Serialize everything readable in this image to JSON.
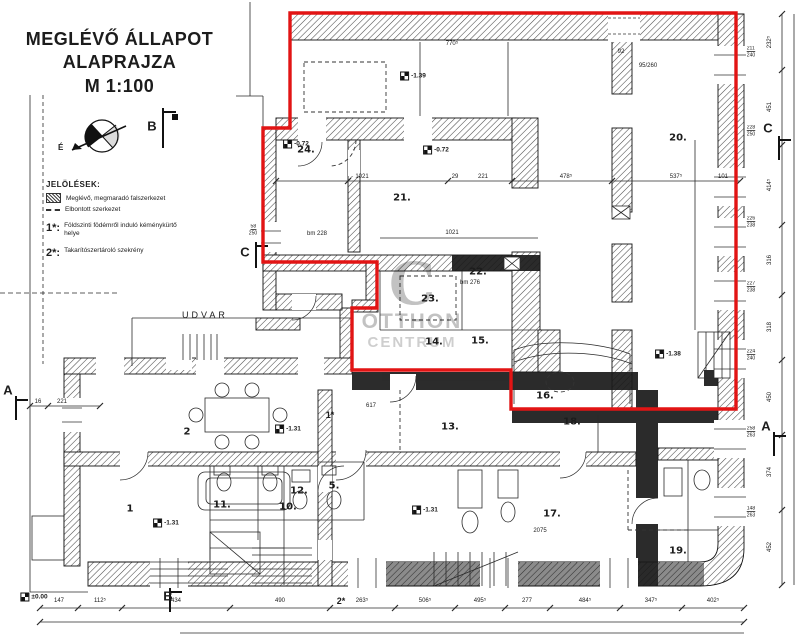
{
  "title_block": {
    "line1": "MEGLÉVŐ ÁLLAPOT",
    "line2": "ALAPRAJZA",
    "line3": "M 1:100"
  },
  "legend": {
    "heading": "JELÖLÉSEK:",
    "items": [
      {
        "swatch": "hatch",
        "label": "Meglévő, megmaradó falszerkezet"
      },
      {
        "swatch": "dashed",
        "label": "Elbontott szerkezet"
      }
    ],
    "notes": [
      {
        "key": "1*:",
        "label": "Földszinti födémről induló kéménykürtő helye"
      },
      {
        "key": "2*:",
        "label": "Takarítószertároló szekrény"
      }
    ]
  },
  "compass": {
    "north_label": "É"
  },
  "watermark": {
    "initial": "C",
    "line1": "OTTHON",
    "line2": "CENTRUM"
  },
  "colors": {
    "highlight_red": "#e21414",
    "ink": "#1c1c1c",
    "watermark_grey": "#8f8f8f"
  },
  "plan": {
    "courtyard_label": "UDVAR",
    "rooms": [
      {
        "n": "1",
        "x": 130,
        "y": 509
      },
      {
        "n": "2",
        "x": 187,
        "y": 432
      },
      {
        "n": "5.",
        "x": 334,
        "y": 486
      },
      {
        "n": "10.",
        "x": 288,
        "y": 507
      },
      {
        "n": "11.",
        "x": 222,
        "y": 505
      },
      {
        "n": "12.",
        "x": 299,
        "y": 491
      },
      {
        "n": "13.",
        "x": 450,
        "y": 427
      },
      {
        "n": "14.",
        "x": 434,
        "y": 342
      },
      {
        "n": "15.",
        "x": 480,
        "y": 341
      },
      {
        "n": "16.",
        "x": 545,
        "y": 396
      },
      {
        "n": "17.",
        "x": 552,
        "y": 514
      },
      {
        "n": "18.",
        "x": 572,
        "y": 422
      },
      {
        "n": "19.",
        "x": 678,
        "y": 551
      },
      {
        "n": "20.",
        "x": 678,
        "y": 138
      },
      {
        "n": "21.",
        "x": 402,
        "y": 198
      },
      {
        "n": "22.",
        "x": 478,
        "y": 272
      },
      {
        "n": "23.",
        "x": 430,
        "y": 299
      },
      {
        "n": "24.",
        "x": 306,
        "y": 150
      }
    ],
    "levels": [
      {
        "v": "-1.39",
        "x": 413,
        "y": 76
      },
      {
        "v": "-0.72",
        "x": 296,
        "y": 144
      },
      {
        "v": "-0.72",
        "x": 436,
        "y": 150
      },
      {
        "v": "-1.38",
        "x": 668,
        "y": 354
      },
      {
        "v": "-1.31",
        "x": 288,
        "y": 429
      },
      {
        "v": "-1.31",
        "x": 166,
        "y": 523
      },
      {
        "v": "-1.31",
        "x": 425,
        "y": 510
      },
      {
        "v": "±0.00",
        "x": 34,
        "y": 597
      }
    ],
    "sections": [
      {
        "l": "B",
        "x": 152,
        "y": 126
      },
      {
        "l": "C",
        "x": 245,
        "y": 252
      },
      {
        "l": "C",
        "x": 768,
        "y": 128
      },
      {
        "l": "A",
        "x": 8,
        "y": 390
      },
      {
        "l": "A",
        "x": 766,
        "y": 426
      },
      {
        "l": "B",
        "x": 168,
        "y": 596
      }
    ],
    "ref_markers": [
      {
        "t": "1*",
        "x": 330,
        "y": 415
      },
      {
        "t": "2*",
        "x": 341,
        "y": 601
      }
    ],
    "inline_dims": [
      {
        "t": "770⁵",
        "x": 452,
        "y": 44
      },
      {
        "t": "92",
        "x": 621,
        "y": 52
      },
      {
        "t": "95/260",
        "x": 648,
        "y": 66
      },
      {
        "t": "1021",
        "x": 362,
        "y": 177
      },
      {
        "t": "29",
        "x": 455,
        "y": 177
      },
      {
        "t": "221",
        "x": 483,
        "y": 177
      },
      {
        "t": "478⁵",
        "x": 566,
        "y": 177
      },
      {
        "t": "537⁵",
        "x": 676,
        "y": 177
      },
      {
        "t": "101",
        "x": 723,
        "y": 177
      },
      {
        "t": "bm 228",
        "x": 317,
        "y": 234
      },
      {
        "t": "1021",
        "x": 452,
        "y": 233
      },
      {
        "t": "bm 276",
        "x": 470,
        "y": 283
      },
      {
        "t": "617",
        "x": 371,
        "y": 406
      },
      {
        "t": "2075",
        "x": 540,
        "y": 531
      },
      {
        "t": "16",
        "x": 38,
        "y": 402
      },
      {
        "t": "221",
        "x": 62,
        "y": 402
      }
    ],
    "window_dims": [
      {
        "a": "211",
        "b": "240",
        "x": 751,
        "y": 52
      },
      {
        "a": "228",
        "b": "250",
        "x": 751,
        "y": 131
      },
      {
        "a": "226",
        "b": "238",
        "x": 751,
        "y": 222
      },
      {
        "a": "227",
        "b": "238",
        "x": 751,
        "y": 287
      },
      {
        "a": "224",
        "b": "240",
        "x": 751,
        "y": 355
      },
      {
        "a": "258",
        "b": "263",
        "x": 751,
        "y": 432
      },
      {
        "a": "148",
        "b": "263",
        "x": 751,
        "y": 512
      },
      {
        "a": "58",
        "b": "250",
        "x": 253,
        "y": 230
      }
    ]
  },
  "dims_bottom": {
    "values": [
      {
        "t": "147",
        "x": 59
      },
      {
        "t": "112⁵",
        "x": 100
      },
      {
        "t": "434",
        "x": 176
      },
      {
        "t": "490",
        "x": 280
      },
      {
        "t": "263⁵",
        "x": 362
      },
      {
        "t": "506⁵",
        "x": 425
      },
      {
        "t": "495⁵",
        "x": 480
      },
      {
        "t": "277",
        "x": 527
      },
      {
        "t": "484⁵",
        "x": 585
      },
      {
        "t": "347⁵",
        "x": 651
      },
      {
        "t": "402⁵",
        "x": 713
      }
    ]
  },
  "dims_right": {
    "x": 770,
    "values": [
      {
        "t": "232⁵",
        "y": 42
      },
      {
        "t": "451",
        "y": 107
      },
      {
        "t": "414⁵",
        "y": 185
      },
      {
        "t": "316",
        "y": 260
      },
      {
        "t": "318",
        "y": 327
      },
      {
        "t": "450",
        "y": 397
      },
      {
        "t": "374",
        "y": 472
      },
      {
        "t": "452",
        "y": 547
      }
    ]
  }
}
